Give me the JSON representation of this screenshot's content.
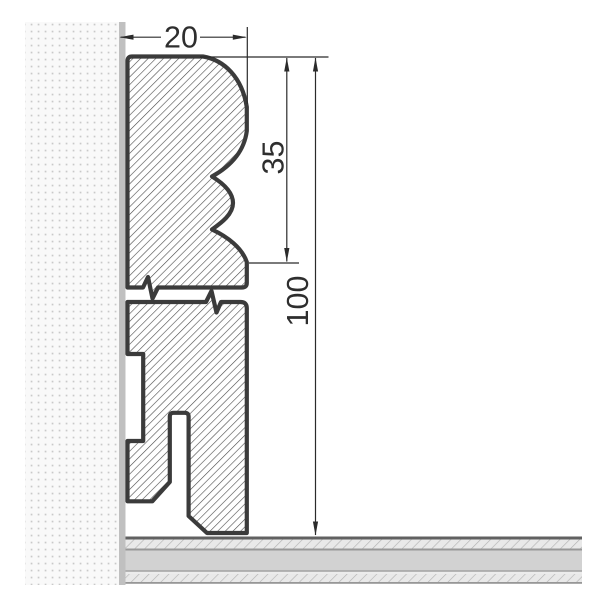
{
  "drawing": {
    "title": "skirting-board-cross-section",
    "dimensions": {
      "width": {
        "value": "20",
        "orientation": "horizontal"
      },
      "upper_profile_height": {
        "value": "35",
        "orientation": "vertical"
      },
      "total_height": {
        "value": "100",
        "orientation": "vertical"
      }
    },
    "features": {
      "wall": "stippled wall section with plaster surface strip",
      "profile": "moulded skirting profile, diagonal hatching, broken with break lines",
      "floor": "layered floor build-up (wear layer, core, backing)"
    },
    "colors": {
      "outline": "#3b3b3b",
      "hatch_line": "#4a4a4a",
      "dimension": "#2b2b2b",
      "wall_dot": "#c9c9c9",
      "wall_surface_strip": "#c0c0c0",
      "floor_core": "#d2d2d2",
      "floor_hatch_bg": "#e9e9e9",
      "floor_hatch_line": "#b3b3b3",
      "background": "#ffffff"
    }
  }
}
